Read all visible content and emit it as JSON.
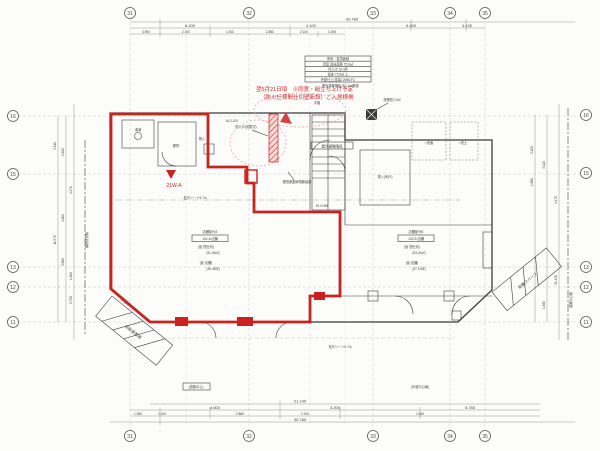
{
  "colors": {
    "red": "#c9231f",
    "line": "#3a3a3a",
    "pink": "#e2a7a4",
    "grid": "#c9c9c9"
  },
  "grid": {
    "top": [
      "31",
      "32",
      "33",
      "34",
      "35"
    ],
    "bottom": [
      "31",
      "32",
      "33",
      "34",
      "35"
    ],
    "left": [
      "16",
      "15",
      "13",
      "12",
      "11"
    ],
    "right": [
      "16",
      "15",
      "13",
      "12",
      "11"
    ]
  },
  "dims": {
    "top": [
      "30.780",
      "8.100",
      "4.100",
      "6.400",
      "4.130",
      "3.900",
      "2.100",
      "1.910",
      "2.850",
      "2.100",
      "1.005"
    ],
    "bottom": [
      "21.140",
      "4.600",
      "3.200",
      "5.785",
      "1.100",
      "2.860",
      "1.910",
      "1.540",
      "1.060",
      "30.780"
    ],
    "left": [
      "3.110",
      "2.620",
      "11.570",
      "4.600",
      "3.860",
      "2.750",
      "1.460",
      "4.470"
    ],
    "right": [
      "2.100",
      "1.880",
      "3.110",
      "21.430",
      "1.460",
      "4.470"
    ]
  },
  "notes": {
    "red_line1": "翌5月21日頃　※同意・組立ち上げ予定",
    "red_line2": "（防火仕様間仕切壁新設）ご入居様側",
    "unit_tag": "21W-A",
    "escape_note": "屋外避難階段 巾1.2m確保"
  },
  "info": {
    "rows": [
      "専有・賃貸面積",
      "貸室 延床面積 75.6㎡",
      "坪上げ 23.4坪",
      "延床 73.6㎡ 上",
      "外壁仕上(塗装) 2098-FC"
    ]
  },
  "labels": {
    "toilet": "便所",
    "yuwakashi": "湯沸",
    "monoire": "物入",
    "fire_door1": "防火戸(常閉式)",
    "fire_door2": "煙感連動扉閉鎖装置",
    "stair": "屋外避難階段",
    "tesuri": "手摺",
    "haien": "排煙窓2.0㎡",
    "al": "AL2.100",
    "el": "EL2.098",
    "roomA1": "店舗部分A",
    "roomA2": "101-A 店舗",
    "roomA3": "(仮 間仕切)",
    "roomA4": "(91.45㎡)",
    "roomA5": "(仮 店舗)",
    "roomA6": "(36.45坪)",
    "roomB1": "店舗部分B",
    "roomB2": "102-B 店舗",
    "roomB3": "(仮 間仕切)",
    "roomB4": "(93.40㎡)",
    "roomB5": "(仮 店舗)",
    "roomB6": "(37.10坪)",
    "front": "長尺シート5.7m",
    "bike": "自転車置場",
    "bike2": "駐輪スペース",
    "cut": "歩道切下げ",
    "road_center_box": "(道路中心)",
    "walk_center": "(歩道中心線)",
    "road_center_line": "道路中心線",
    "boundary": "隣地境界線",
    "senmen1": "□洗面",
    "senmen2": "□洗土",
    "shelf": "物入(吊戸)"
  }
}
